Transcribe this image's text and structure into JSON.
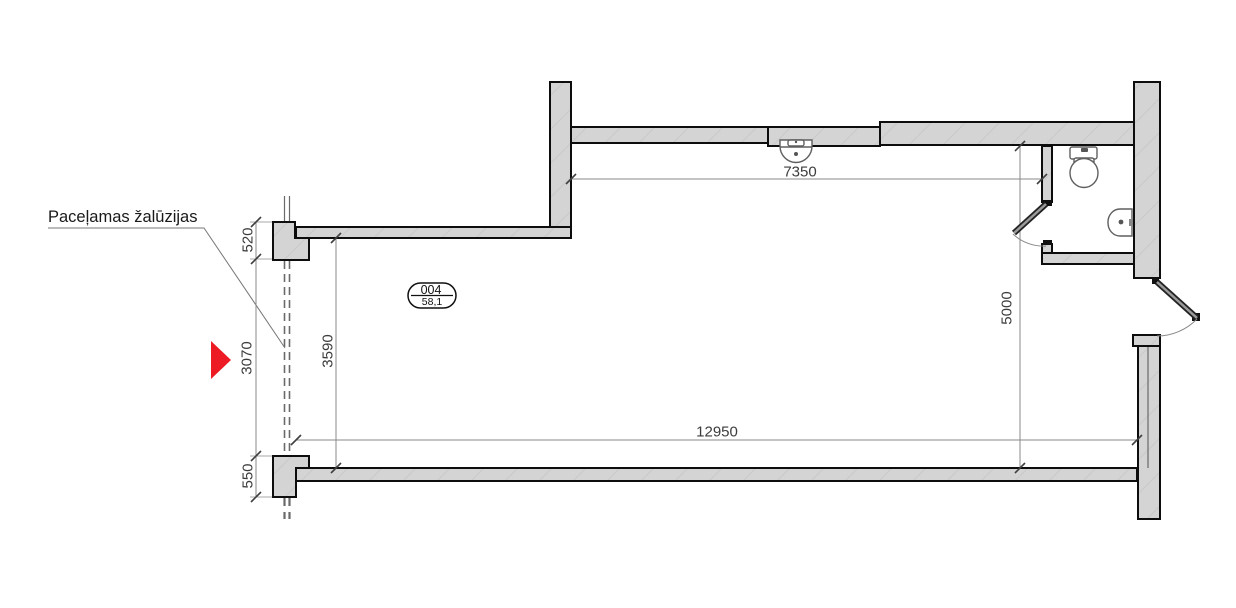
{
  "drawing": {
    "annotation": {
      "label": "Paceļamas žalūzijas"
    },
    "room_tag": {
      "number": "004",
      "area_m2": "58,1"
    },
    "dimensions": {
      "top_interior_width": "7350",
      "right_interior_height": "5000",
      "bottom_interior_width": "12950",
      "left_interior_height": "3590",
      "left_pier_top": "520",
      "window_opening": "3070",
      "left_pier_bottom": "550"
    },
    "fixtures": [
      "washbasin-icon",
      "toilet-icon",
      "hand-sink-icon"
    ],
    "colors": {
      "background": "#ffffff",
      "wall_fill": "#d4d4d4",
      "wall_outline": "#0d0d0d",
      "dimension_line": "#8a8a8a",
      "dimension_text": "#3c3c3c",
      "marker_red": "#ed1c24"
    }
  }
}
